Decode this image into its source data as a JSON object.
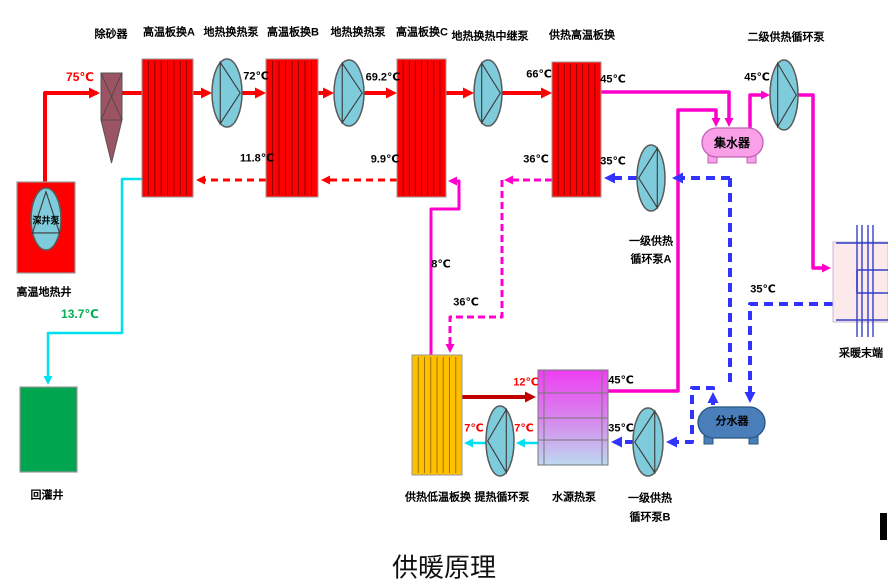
{
  "title": "供暖原理",
  "canvas": {
    "w": 888,
    "h": 586
  },
  "colors": {
    "hot": "#ff0000",
    "cyan": "#00e0ee",
    "magenta": "#ff00cc",
    "blue": "#3333ff",
    "darkred": "#c00000",
    "gray": "#888888",
    "pump_fill": "#7ecbdb",
    "pump_stroke": "#5a5a5a",
    "exchanger_red": "#ff0000",
    "exchanger_orange": "#ffc000",
    "sand": "#9c5363",
    "collector": "#f9a0e8",
    "distributor": "#4a7ebb",
    "well": "#ff0000",
    "reinjection": "#00a54f",
    "radiator_fill": "#fbe9ec",
    "radiator_line": "#3340c8",
    "wsp_top": "#ee3ef2",
    "wsp_mid": "#d884ee",
    "wsp_bottom": "#bdd8ef"
  },
  "exchangers": [
    {
      "name": "hx-a-box",
      "x": 142,
      "y": 59,
      "w": 51,
      "h": 138,
      "fill": "#ff0000",
      "line": "#8b0000",
      "n": 7
    },
    {
      "name": "hx-b-box",
      "x": 266,
      "y": 59,
      "w": 52,
      "h": 138,
      "fill": "#ff0000",
      "line": "#8b0000",
      "n": 7
    },
    {
      "name": "hx-c-box",
      "x": 397,
      "y": 59,
      "w": 49,
      "h": 138,
      "fill": "#ff0000",
      "line": "#8b0000",
      "n": 7
    },
    {
      "name": "hx-heating-high-box",
      "x": 552,
      "y": 62,
      "w": 49,
      "h": 135,
      "fill": "#ff0000",
      "line": "#8b0000",
      "n": 7
    },
    {
      "name": "hx-heating-low-box",
      "x": 412,
      "y": 355,
      "w": 50,
      "h": 120,
      "fill": "#ffc000",
      "line": "#a07000",
      "n": 7
    }
  ],
  "pumps": [
    {
      "name": "pump-geothermal-1-icon",
      "cx": 227,
      "cy": 93,
      "rx": 15,
      "ry": 34,
      "dir": "r"
    },
    {
      "name": "pump-geothermal-2-icon",
      "cx": 349,
      "cy": 93,
      "rx": 15,
      "ry": 33,
      "dir": "r"
    },
    {
      "name": "pump-geothermal-relay-icon",
      "cx": 488,
      "cy": 93,
      "rx": 14,
      "ry": 33,
      "dir": "r"
    },
    {
      "name": "pump-secondary-heating-icon",
      "cx": 784,
      "cy": 95,
      "rx": 14,
      "ry": 35,
      "dir": "r"
    },
    {
      "name": "pump-primary-heating-a-icon",
      "cx": 651,
      "cy": 178,
      "rx": 14,
      "ry": 33,
      "dir": "l"
    },
    {
      "name": "pump-primary-heating-b-icon",
      "cx": 648,
      "cy": 442,
      "rx": 15,
      "ry": 34,
      "dir": "l"
    },
    {
      "name": "pump-heat-extraction-icon",
      "cx": 500,
      "cy": 441,
      "rx": 14,
      "ry": 35,
      "dir": "l"
    },
    {
      "name": "pump-deep-well-icon",
      "cx": 46,
      "cy": 219,
      "rx": 15,
      "ry": 31,
      "dir": "u"
    }
  ],
  "tanks": [
    {
      "name": "collector-tank",
      "x": 702,
      "y": 128,
      "w": 61,
      "h": 29,
      "fill": "#f9a0e8",
      "stroke": "#c060b8"
    },
    {
      "name": "distributor-tank",
      "x": 698,
      "y": 407,
      "w": 67,
      "h": 31,
      "fill": "#4a7ebb",
      "stroke": "#27567f"
    }
  ],
  "rects": [
    {
      "name": "geothermal-well-box",
      "x": 17,
      "y": 182,
      "w": 58,
      "h": 91,
      "fill": "#ff0000",
      "stroke": "#999999"
    },
    {
      "name": "reinjection-well-box",
      "x": 20,
      "y": 387,
      "w": 57,
      "h": 85,
      "fill": "#00a54f",
      "stroke": "#999999"
    },
    {
      "name": "cursor-bar",
      "x": 880,
      "y": 513,
      "w": 7,
      "h": 27,
      "fill": "#000000",
      "stroke": "none"
    }
  ],
  "sand_separator": {
    "name": "sand-separator-icon",
    "x": 101,
    "y": 73,
    "w": 21,
    "sq_bottom": 120,
    "tip_y": 163,
    "fill": "#9c5363",
    "stroke": "#555555"
  },
  "water_source_hp": {
    "name": "water-source-heat-pump-box",
    "x": 538,
    "y": 370,
    "w": 70,
    "h": 95,
    "hlines": [
      393,
      418,
      440
    ],
    "vlines": [
      544,
      602
    ],
    "stroke": "#777777"
  },
  "radiator": {
    "name": "radiator-terminal",
    "x": 833,
    "y": 242,
    "w": 55,
    "h": 80,
    "verts": [
      857,
      862,
      868,
      873
    ],
    "vy1": 225,
    "vy2": 337,
    "h_top": 243,
    "h_bottom": 320,
    "h_mid1": 270,
    "h_mid2": 293,
    "mid_x": 857
  },
  "pipes": [
    {
      "name": "pipe-axle-pump1",
      "c": "gray",
      "w": 1.3,
      "pts": [
        [
          213,
          93
        ],
        [
          241,
          93
        ]
      ]
    },
    {
      "name": "pipe-axle-pump2",
      "c": "gray",
      "w": 1.3,
      "pts": [
        [
          335,
          93
        ],
        [
          363,
          93
        ]
      ]
    },
    {
      "name": "pipe-axle-pump3",
      "c": "gray",
      "w": 1.3,
      "pts": [
        [
          474,
          93
        ],
        [
          502,
          93
        ]
      ]
    },
    {
      "name": "pipe-axle-pump4",
      "c": "gray",
      "w": 1.3,
      "pts": [
        [
          770,
          95
        ],
        [
          798,
          95
        ]
      ]
    },
    {
      "name": "pipe-axle-pump-a",
      "c": "gray",
      "w": 1.3,
      "pts": [
        [
          637,
          178
        ],
        [
          665,
          178
        ]
      ]
    },
    {
      "name": "pipe-axle-pump-b",
      "c": "gray",
      "w": 1.3,
      "pts": [
        [
          634,
          442
        ],
        [
          662,
          442
        ]
      ]
    },
    {
      "name": "pipe-axle-pump-extract",
      "c": "gray",
      "w": 1.3,
      "pts": [
        [
          487,
          441
        ],
        [
          513,
          441
        ]
      ]
    },
    {
      "name": "pipe-axle-deep-well",
      "c": "gray",
      "w": 1.2,
      "pts": [
        [
          46,
          191
        ],
        [
          46,
          248
        ]
      ]
    },
    {
      "name": "pipe-well-to-sand",
      "c": "hot",
      "w": 4,
      "pts": [
        [
          45,
          185
        ],
        [
          45,
          93
        ],
        [
          97,
          93
        ]
      ],
      "arrows": [
        [
          100,
          93,
          "r"
        ]
      ]
    },
    {
      "name": "pipe-sand-to-hxa",
      "c": "hot",
      "w": 4,
      "pts": [
        [
          122,
          93
        ],
        [
          144,
          93
        ]
      ]
    },
    {
      "name": "pipe-hxa-to-pump1",
      "c": "hot",
      "w": 4,
      "pts": [
        [
          193,
          93
        ],
        [
          208,
          93
        ]
      ],
      "arrows": [
        [
          212,
          93,
          "r"
        ]
      ]
    },
    {
      "name": "pipe-pump1-to-hxb",
      "c": "hot",
      "w": 4,
      "pts": [
        [
          242,
          93
        ],
        [
          262,
          93
        ]
      ],
      "arrows": [
        [
          266,
          93,
          "r"
        ]
      ]
    },
    {
      "name": "pipe-hxb-to-pump2",
      "c": "hot",
      "w": 4,
      "pts": [
        [
          318,
          93
        ],
        [
          330,
          93
        ]
      ],
      "arrows": [
        [
          334,
          93,
          "r"
        ]
      ]
    },
    {
      "name": "pipe-pump2-to-hxc",
      "c": "hot",
      "w": 4,
      "pts": [
        [
          364,
          93
        ],
        [
          393,
          93
        ]
      ],
      "arrows": [
        [
          397,
          93,
          "r"
        ]
      ]
    },
    {
      "name": "pipe-hxc-to-pump3",
      "c": "hot",
      "w": 4,
      "pts": [
        [
          446,
          93
        ],
        [
          470,
          93
        ]
      ],
      "arrows": [
        [
          474,
          93,
          "r"
        ]
      ]
    },
    {
      "name": "pipe-pump3-to-hxh",
      "c": "hot",
      "w": 4,
      "pts": [
        [
          502,
          93
        ],
        [
          548,
          93
        ]
      ],
      "arrows": [
        [
          552,
          93,
          "r"
        ]
      ]
    },
    {
      "name": "pipe-return-c-to-b",
      "c": "hot",
      "w": 3,
      "dash": "7,5",
      "pts": [
        [
          397,
          180
        ],
        [
          324,
          180
        ]
      ],
      "arrows": [
        [
          321,
          180,
          "l"
        ]
      ]
    },
    {
      "name": "pipe-return-b-to-a",
      "c": "hot",
      "w": 3,
      "dash": "7,5",
      "pts": [
        [
          266,
          180
        ],
        [
          200,
          180
        ]
      ],
      "arrows": [
        [
          196,
          180,
          "l"
        ]
      ]
    },
    {
      "name": "pipe-reinjection",
      "c": "cyan",
      "w": 2.5,
      "pts": [
        [
          142,
          179
        ],
        [
          122,
          179
        ],
        [
          122,
          333
        ],
        [
          48,
          333
        ],
        [
          48,
          380
        ]
      ],
      "arrows": [
        [
          48,
          385,
          "d"
        ]
      ]
    },
    {
      "name": "pipe-hxh-to-collector",
      "c": "magenta",
      "w": 3.5,
      "pts": [
        [
          601,
          92
        ],
        [
          729,
          92
        ],
        [
          729,
          122
        ]
      ],
      "arrows": [
        [
          729,
          127,
          "d"
        ]
      ]
    },
    {
      "name": "pipe-wshp-to-collector",
      "c": "magenta",
      "w": 3.5,
      "pts": [
        [
          608,
          391
        ],
        [
          678,
          391
        ],
        [
          678,
          110
        ],
        [
          716,
          110
        ],
        [
          716,
          122
        ]
      ],
      "arrows": [
        [
          716,
          127,
          "d"
        ]
      ]
    },
    {
      "name": "pipe-collector-to-pump4",
      "c": "magenta",
      "w": 3.5,
      "pts": [
        [
          750,
          129
        ],
        [
          750,
          95
        ],
        [
          766,
          95
        ]
      ],
      "arrows": [
        [
          770,
          95,
          "r"
        ]
      ]
    },
    {
      "name": "pipe-pump4-to-radiator",
      "c": "magenta",
      "w": 3.5,
      "pts": [
        [
          798,
          95
        ],
        [
          813,
          95
        ],
        [
          813,
          268
        ],
        [
          827,
          268
        ]
      ],
      "arrows": [
        [
          831,
          268,
          "r"
        ]
      ]
    },
    {
      "name": "pipe-8c-loop",
      "c": "magenta",
      "w": 3,
      "pts": [
        [
          431,
          356
        ],
        [
          431,
          209
        ],
        [
          459,
          209
        ],
        [
          459,
          181
        ],
        [
          452,
          181
        ]
      ],
      "arrows": [
        [
          448,
          181,
          "l"
        ]
      ]
    },
    {
      "name": "pipe-36c-top",
      "c": "magenta",
      "w": 3,
      "dash": "7,4",
      "pts": [
        [
          552,
          180
        ],
        [
          507,
          180
        ]
      ],
      "arrows": [
        [
          504,
          180,
          "l"
        ]
      ]
    },
    {
      "name": "pipe-36c-down",
      "c": "magenta",
      "w": 3,
      "dash": "7,4",
      "pts": [
        [
          502,
          180
        ],
        [
          502,
          317
        ],
        [
          450,
          317
        ],
        [
          450,
          349
        ]
      ],
      "arrows": [
        [
          450,
          353,
          "d"
        ]
      ]
    },
    {
      "name": "pipe-35c-to-pump-a",
      "c": "blue",
      "w": 4,
      "dash": "9,6",
      "pts": [
        [
          730,
          178
        ],
        [
          677,
          178
        ]
      ],
      "arrows": [
        [
          672,
          178,
          "l"
        ]
      ]
    },
    {
      "name": "pipe-pump-a-to-hxh",
      "c": "blue",
      "w": 4,
      "dash": "9,6",
      "pts": [
        [
          637,
          178
        ],
        [
          609,
          178
        ]
      ],
      "arrows": [
        [
          604,
          178,
          "l"
        ]
      ]
    },
    {
      "name": "pipe-return-riser",
      "c": "blue",
      "w": 4,
      "dash": "9,6",
      "pts": [
        [
          730,
          178
        ],
        [
          730,
          383
        ]
      ]
    },
    {
      "name": "pipe-radiator-return",
      "c": "blue",
      "w": 4,
      "dash": "9,6",
      "pts": [
        [
          833,
          304
        ],
        [
          750,
          304
        ],
        [
          750,
          398
        ]
      ],
      "arrows": [
        [
          750,
          403,
          "d"
        ]
      ]
    },
    {
      "name": "pipe-distributor-to-pump-b",
      "c": "blue",
      "w": 4,
      "dash": "9,6",
      "pts": [
        [
          713,
          405
        ],
        [
          713,
          388
        ],
        [
          692,
          388
        ],
        [
          692,
          442
        ],
        [
          670,
          442
        ]
      ],
      "arrows": [
        [
          713,
          392,
          "u"
        ],
        [
          666,
          442,
          "l"
        ]
      ]
    },
    {
      "name": "pipe-pump-b-to-wshp",
      "c": "blue",
      "w": 4,
      "dash": "9,6",
      "pts": [
        [
          634,
          442
        ],
        [
          616,
          442
        ]
      ],
      "arrows": [
        [
          611,
          442,
          "l"
        ]
      ]
    },
    {
      "name": "pipe-7c-right",
      "c": "cyan",
      "w": 2.5,
      "pts": [
        [
          538,
          443
        ],
        [
          520,
          443
        ]
      ],
      "arrows": [
        [
          516,
          443,
          "l"
        ]
      ]
    },
    {
      "name": "pipe-7c-left",
      "c": "cyan",
      "w": 2.5,
      "pts": [
        [
          487,
          443
        ],
        [
          468,
          443
        ]
      ],
      "arrows": [
        [
          464,
          443,
          "l"
        ]
      ]
    },
    {
      "name": "pipe-12c",
      "c": "darkred",
      "w": 4,
      "pts": [
        [
          462,
          397
        ],
        [
          532,
          397
        ]
      ],
      "arrows": [
        [
          536,
          397,
          "r"
        ]
      ]
    }
  ],
  "labels": [
    {
      "name": "label-sand-separator",
      "text": "除砂器",
      "x": 111,
      "y": 35,
      "size": 11
    },
    {
      "name": "label-hx-a",
      "text": "高温板换A",
      "x": 169,
      "y": 33,
      "size": 11
    },
    {
      "name": "label-pump-geothermal-1",
      "text": "地热换热泵",
      "x": 231,
      "y": 33,
      "size": 11
    },
    {
      "name": "label-hx-b",
      "text": "高温板换B",
      "x": 293,
      "y": 33,
      "size": 11
    },
    {
      "name": "label-pump-geothermal-2",
      "text": "地热换热泵",
      "x": 358,
      "y": 33,
      "size": 11
    },
    {
      "name": "label-hx-c",
      "text": "高温板换C",
      "x": 422,
      "y": 33,
      "size": 11
    },
    {
      "name": "label-pump-relay",
      "text": "地热换热中继泵",
      "x": 490,
      "y": 37,
      "size": 11
    },
    {
      "name": "label-hx-heating-high",
      "text": "供热高温板换",
      "x": 582,
      "y": 36,
      "size": 11
    },
    {
      "name": "label-pump-secondary",
      "text": "二级供热循环泵",
      "x": 786,
      "y": 38,
      "size": 11
    },
    {
      "name": "label-geothermal-well",
      "text": "高温地热井",
      "x": 44,
      "y": 293,
      "size": 11
    },
    {
      "name": "label-reinjection-well",
      "text": "回灌井",
      "x": 47,
      "y": 496,
      "size": 11
    },
    {
      "name": "label-hx-heating-low",
      "text": "供热低温板换",
      "x": 438,
      "y": 498,
      "size": 11
    },
    {
      "name": "label-pump-heat-extraction",
      "text": "提热循环泵",
      "x": 502,
      "y": 498,
      "size": 11
    },
    {
      "name": "label-water-source-hp",
      "text": "水源热泵",
      "x": 574,
      "y": 498,
      "size": 11
    },
    {
      "name": "label-pump-a-line1",
      "text": "一级供热",
      "x": 651,
      "y": 242,
      "size": 11
    },
    {
      "name": "label-pump-a-line2",
      "text": "循环泵A",
      "x": 651,
      "y": 260,
      "size": 11
    },
    {
      "name": "label-pump-b-line1",
      "text": "一级供热",
      "x": 650,
      "y": 499,
      "size": 11
    },
    {
      "name": "label-pump-b-line2",
      "text": "循环泵B",
      "x": 650,
      "y": 518,
      "size": 11
    },
    {
      "name": "label-radiator",
      "text": "采暖末端",
      "x": 861,
      "y": 354,
      "size": 11
    },
    {
      "name": "label-collector",
      "text": "集水器",
      "x": 732,
      "y": 143,
      "size": 12
    },
    {
      "name": "label-distributor",
      "text": "分水器",
      "x": 732,
      "y": 422,
      "size": 11
    },
    {
      "name": "label-deep-well-pump",
      "text": "深井泵",
      "x": 46,
      "y": 221,
      "size": 9
    },
    {
      "name": "temp-75c",
      "text": "75℃",
      "x": 80,
      "y": 77,
      "size": 12,
      "color": "#ff0000"
    },
    {
      "name": "temp-72c",
      "text": "72℃",
      "x": 256,
      "y": 77,
      "size": 11
    },
    {
      "name": "temp-69-2c",
      "text": "69.2℃",
      "x": 383,
      "y": 78,
      "size": 11
    },
    {
      "name": "temp-66c",
      "text": "66℃",
      "x": 539,
      "y": 75,
      "size": 11
    },
    {
      "name": "temp-45c-hxh",
      "text": "45℃",
      "x": 613,
      "y": 80,
      "size": 11
    },
    {
      "name": "temp-45c-pump4",
      "text": "45℃",
      "x": 757,
      "y": 78,
      "size": 11
    },
    {
      "name": "temp-11-8c",
      "text": "11.8℃",
      "x": 257,
      "y": 159,
      "size": 11
    },
    {
      "name": "temp-9-9c",
      "text": "9.9℃",
      "x": 385,
      "y": 160,
      "size": 11
    },
    {
      "name": "temp-36c-top",
      "text": "36℃",
      "x": 536,
      "y": 160,
      "size": 11
    },
    {
      "name": "temp-35c-hxh",
      "text": "35℃",
      "x": 613,
      "y": 162,
      "size": 11
    },
    {
      "name": "temp-8c",
      "text": "8℃",
      "x": 441,
      "y": 265,
      "size": 11
    },
    {
      "name": "temp-36c-bottom",
      "text": "36℃",
      "x": 466,
      "y": 303,
      "size": 11
    },
    {
      "name": "temp-35c-radiator",
      "text": "35℃",
      "x": 763,
      "y": 290,
      "size": 11
    },
    {
      "name": "temp-45c-wshp",
      "text": "45℃",
      "x": 621,
      "y": 381,
      "size": 11
    },
    {
      "name": "temp-35c-wshp",
      "text": "35℃",
      "x": 621,
      "y": 429,
      "size": 11
    },
    {
      "name": "temp-12c",
      "text": "12℃",
      "x": 526,
      "y": 383,
      "size": 11,
      "color": "#ff0000"
    },
    {
      "name": "temp-7c-left",
      "text": "7℃",
      "x": 474,
      "y": 429,
      "size": 11,
      "color": "#ff0000"
    },
    {
      "name": "temp-7c-right",
      "text": "7℃",
      "x": 524,
      "y": 429,
      "size": 11,
      "color": "#ff0000"
    },
    {
      "name": "temp-13-7c",
      "text": "13.7℃",
      "x": 80,
      "y": 314,
      "size": 12,
      "color": "#00b050"
    }
  ]
}
